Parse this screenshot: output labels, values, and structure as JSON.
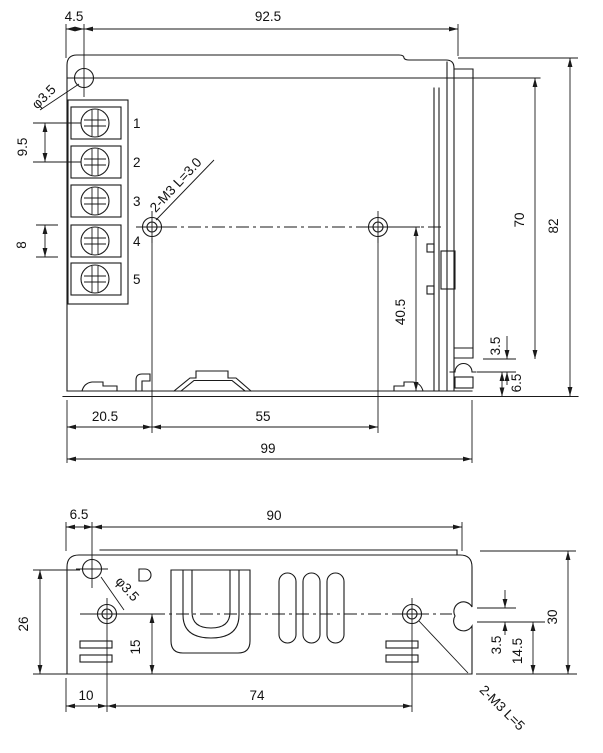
{
  "colors": {
    "line": "#1a1a1a",
    "background": "#ffffff"
  },
  "top_view": {
    "name": "top view",
    "terminals": [
      "1",
      "2",
      "3",
      "4",
      "5"
    ],
    "dims": {
      "offset_left": "4.5",
      "body_width": "92.5",
      "hole_diameter": "φ3.5",
      "terminal_pitch_ac": "9.5",
      "terminal_pitch_dc": "8",
      "screw_spec": "2-M3 L=3.0",
      "hole_height": "40.5",
      "inner_height": "70",
      "total_height": "82",
      "slot_offset": "3.5",
      "slot_height": "6.5",
      "hole_offset": "20.5",
      "hole_spacing": "55",
      "total_width": "99"
    }
  },
  "side_view": {
    "name": "side view",
    "dims": {
      "hole_offset_left": "6.5",
      "mounting_width": "90",
      "hole_diameter": "φ3.5",
      "height_left": "26",
      "hole_height": "15",
      "foot_offset": "10",
      "hole_spacing": "74",
      "slot_offset": "3.5",
      "slot_height": "14.5",
      "total_height": "30",
      "screw_spec": "2-M3 L=5"
    }
  }
}
